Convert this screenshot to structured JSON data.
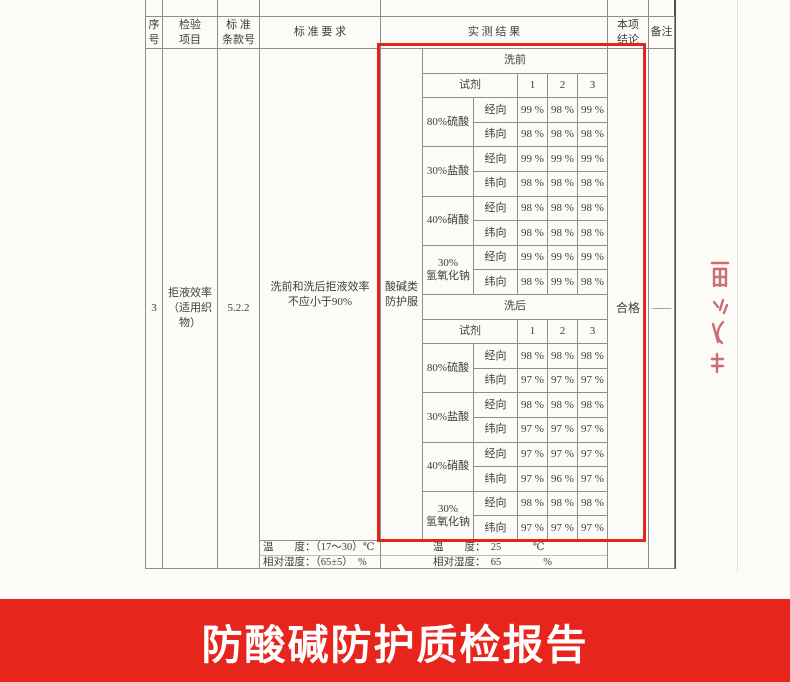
{
  "banner": {
    "title": "防酸碱防护质检报告",
    "bg_color": "#e8251c",
    "text_color": "#ffffff"
  },
  "overlay": {
    "highlight_color": "#e3261a",
    "stamp_color": "#c4555c"
  },
  "table": {
    "header": {
      "serial": "序\n号",
      "item": "检验\n项目",
      "clause": "标 准\n条款号",
      "requirement": "标 准 要 求",
      "result": "实 测 结 果",
      "conclusion": "本项\n结论",
      "remark": "备注"
    },
    "row": {
      "serial": "3",
      "item": "拒液效率\n（适用织物）",
      "clause": "5.2.2",
      "requirement": "洗前和洗后拒液效率\n不应小于90%",
      "category": "酸碱类\n防护服",
      "conclusion": "合格",
      "remark": "——"
    },
    "inner": {
      "reagent_label": "试剂",
      "samples": [
        "1",
        "2",
        "3"
      ],
      "warp_label": "经向",
      "weft_label": "纬向",
      "sections": [
        {
          "phase": "洗前",
          "groups": [
            {
              "reagent": "80%硫酸",
              "warp": [
                "99 %",
                "98 %",
                "99 %"
              ],
              "weft": [
                "98 %",
                "98 %",
                "98 %"
              ]
            },
            {
              "reagent": "30%盐酸",
              "warp": [
                "99 %",
                "99 %",
                "99 %"
              ],
              "weft": [
                "98 %",
                "98 %",
                "98 %"
              ]
            },
            {
              "reagent": "40%硝酸",
              "warp": [
                "98 %",
                "98 %",
                "98 %"
              ],
              "weft": [
                "98 %",
                "98 %",
                "98 %"
              ]
            },
            {
              "reagent": "30%\n氢氧化钠",
              "warp": [
                "99 %",
                "99 %",
                "99 %"
              ],
              "weft": [
                "98 %",
                "99 %",
                "98 %"
              ]
            }
          ]
        },
        {
          "phase": "洗后",
          "groups": [
            {
              "reagent": "80%硫酸",
              "warp": [
                "98 %",
                "98 %",
                "98 %"
              ],
              "weft": [
                "97 %",
                "97 %",
                "97 %"
              ]
            },
            {
              "reagent": "30%盐酸",
              "warp": [
                "98 %",
                "98 %",
                "98 %"
              ],
              "weft": [
                "97 %",
                "97 %",
                "97 %"
              ]
            },
            {
              "reagent": "40%硝酸",
              "warp": [
                "97 %",
                "97 %",
                "97 %"
              ],
              "weft": [
                "97 %",
                "96 %",
                "97 %"
              ]
            },
            {
              "reagent": "30%\n氢氧化钠",
              "warp": [
                "98 %",
                "98 %",
                "98 %"
              ],
              "weft": [
                "97 %",
                "97 %",
                "97 %"
              ]
            }
          ]
        }
      ]
    },
    "environment": {
      "required_temperature": "温　　度：（17～30）℃",
      "required_humidity": "相对湿度：（65±5）　%",
      "measured_temperature": "温　　度：　25　　　℃",
      "measured_humidity": "相对湿度：　65　　　　%"
    }
  }
}
